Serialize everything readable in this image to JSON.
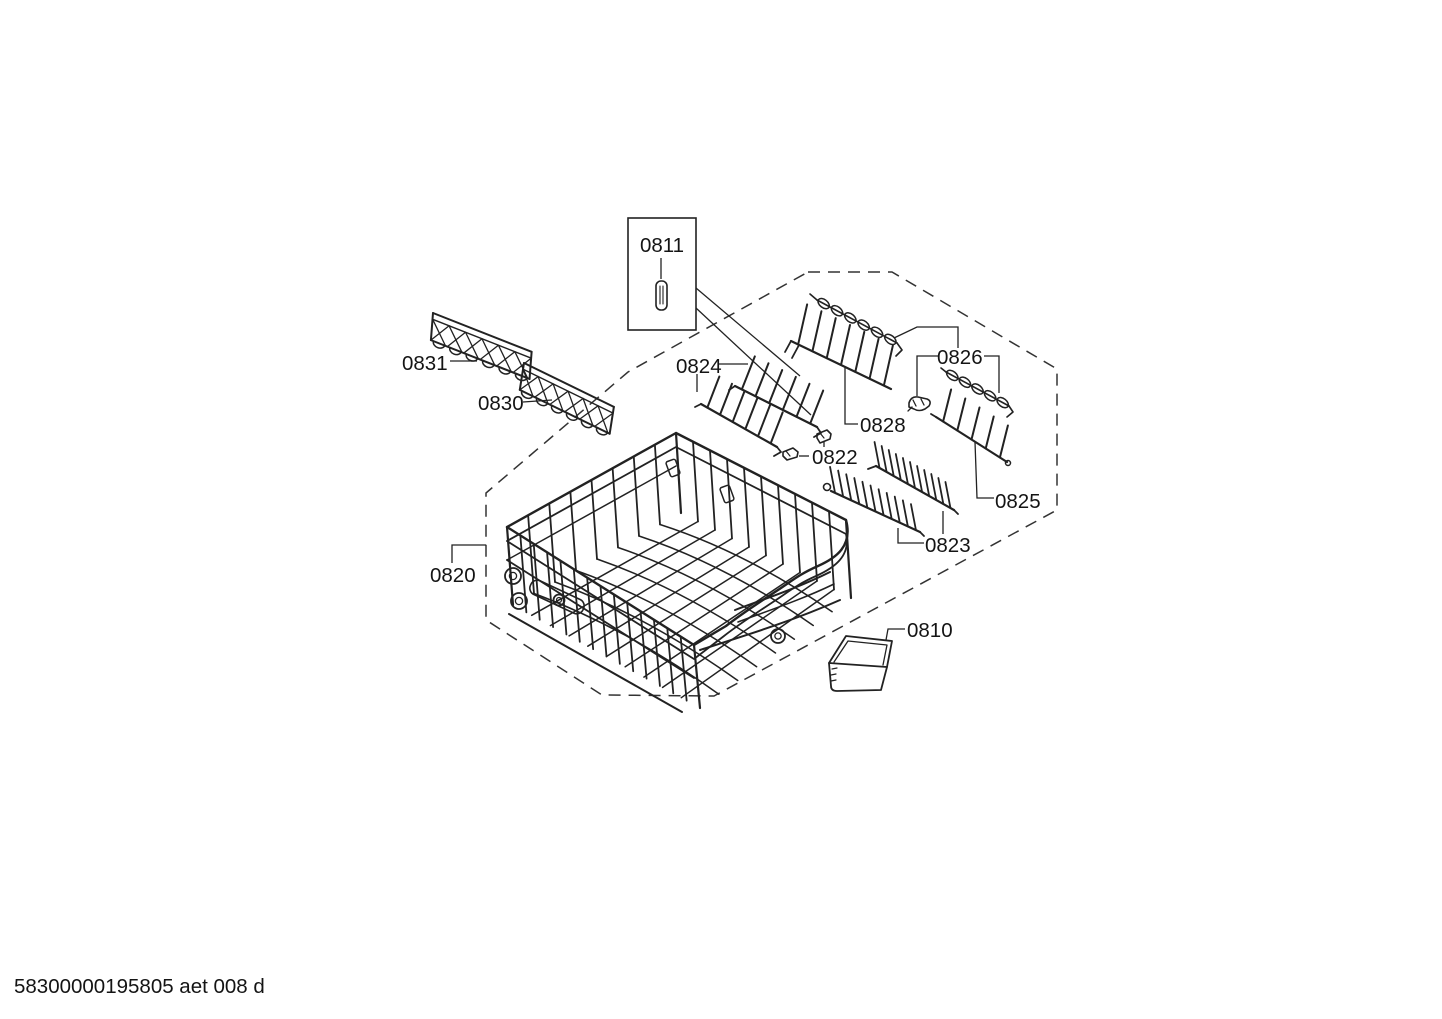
{
  "document": {
    "type": "appliance exploded parts diagram",
    "footer_code": "58300000195805 aet 008 d"
  },
  "colors": {
    "line": "#222222",
    "background": "#ffffff",
    "roller_fill": "#d9d9d9"
  },
  "parts": {
    "cap": {
      "label": "0811"
    },
    "tray": {
      "label": "0810"
    },
    "basket": {
      "label": "0820"
    },
    "clip_pair": {
      "label": "0822"
    },
    "plate_inserts": {
      "label": "0823"
    },
    "tine_row_pair": {
      "label": "0824"
    },
    "tine_row_right": {
      "label": "0825"
    },
    "bearing_clip": {
      "label": "0826"
    },
    "tine_row_top": {
      "label": "0828"
    },
    "cup_shelf_front": {
      "label": "0830"
    },
    "cup_shelf_back": {
      "label": "0831"
    }
  }
}
